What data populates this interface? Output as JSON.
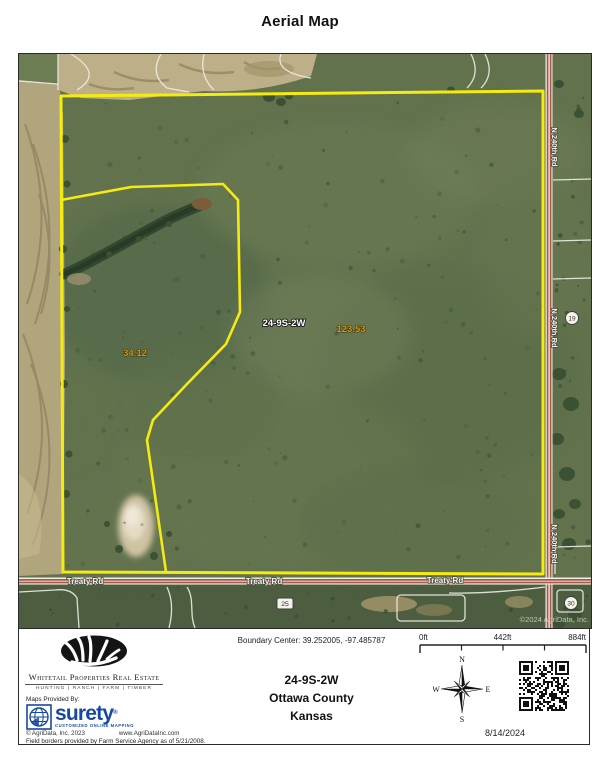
{
  "title": "Aerial Map",
  "map": {
    "parcel_labels": {
      "section": "24-9S-2W",
      "acres_main": "123.53",
      "acres_west": "34.12"
    },
    "roads": {
      "treaty": "Treaty Rd",
      "n240th": "N 240th Rd"
    },
    "section_markers": {
      "s19": "19",
      "s25": "25",
      "s30": "30"
    },
    "watermark": "©2024 AgriData, Inc.",
    "colors": {
      "boundary": "#F5EB10",
      "acreage_text": "#C89B20",
      "road_center": "#A65A4A"
    }
  },
  "footer": {
    "brand": {
      "name": "Whitetail Properties Real Estate",
      "tagline": "HUNTING  |  RANCH  |  FARM  |  TIMBER",
      "maps_provided_by": "Maps Provided By:",
      "surety_name": "surety",
      "surety_reg": "®",
      "surety_tagline": "CUSTOMIZED ONLINE MAPPING",
      "agridata_copyright": "© AgriData, Inc. 2023",
      "agridata_url": "www.AgriDataInc.com",
      "field_note": "Field borders provided by Farm Service Agency as of 5/21/2008."
    },
    "center": {
      "boundary_center": "Boundary Center: 39.252005, -97.485787",
      "section": "24-9S-2W",
      "county": "Ottawa County",
      "state": "Kansas"
    },
    "scale": {
      "zero": "0ft",
      "mid": "442ft",
      "max": "884ft"
    },
    "compass": {
      "n": "N",
      "e": "E",
      "s": "S",
      "w": "W"
    },
    "date": "8/14/2024"
  }
}
